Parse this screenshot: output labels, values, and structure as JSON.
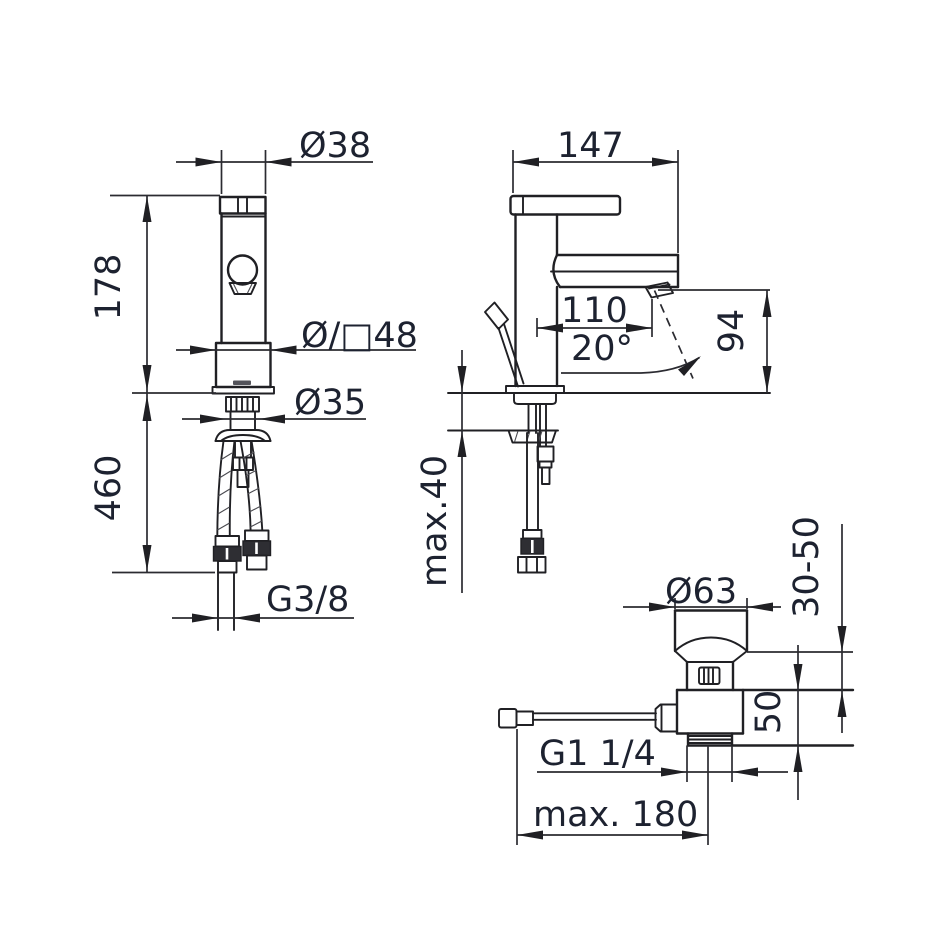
{
  "drawing_type": "basin mixer installation dimensional drawing",
  "colors": {
    "background": "#ffffff",
    "object_line": "#202024",
    "dimension_line": "#2b2b31",
    "text": "#1d2230"
  },
  "views": {
    "front_view": {
      "dimensions": {
        "spout_dia": "Ø38",
        "height_above_deck": "178",
        "body_width": "Ø/□48",
        "shank_dia": "Ø35",
        "height_below_deck": "460",
        "supply_thread": "G3/8"
      }
    },
    "side_view": {
      "dimensions": {
        "depth": "147",
        "spout_reach": "110",
        "spout_angle": "20°",
        "outlet_height": "94",
        "deck_thickness_max": "max.40"
      }
    },
    "drain_view": {
      "dimensions": {
        "plug_dia": "Ø63",
        "deck_thickness_range": "30-50",
        "below_deck_length": "50",
        "waste_thread": "G1 1/4",
        "rod_length_max": "max. 180"
      }
    }
  }
}
